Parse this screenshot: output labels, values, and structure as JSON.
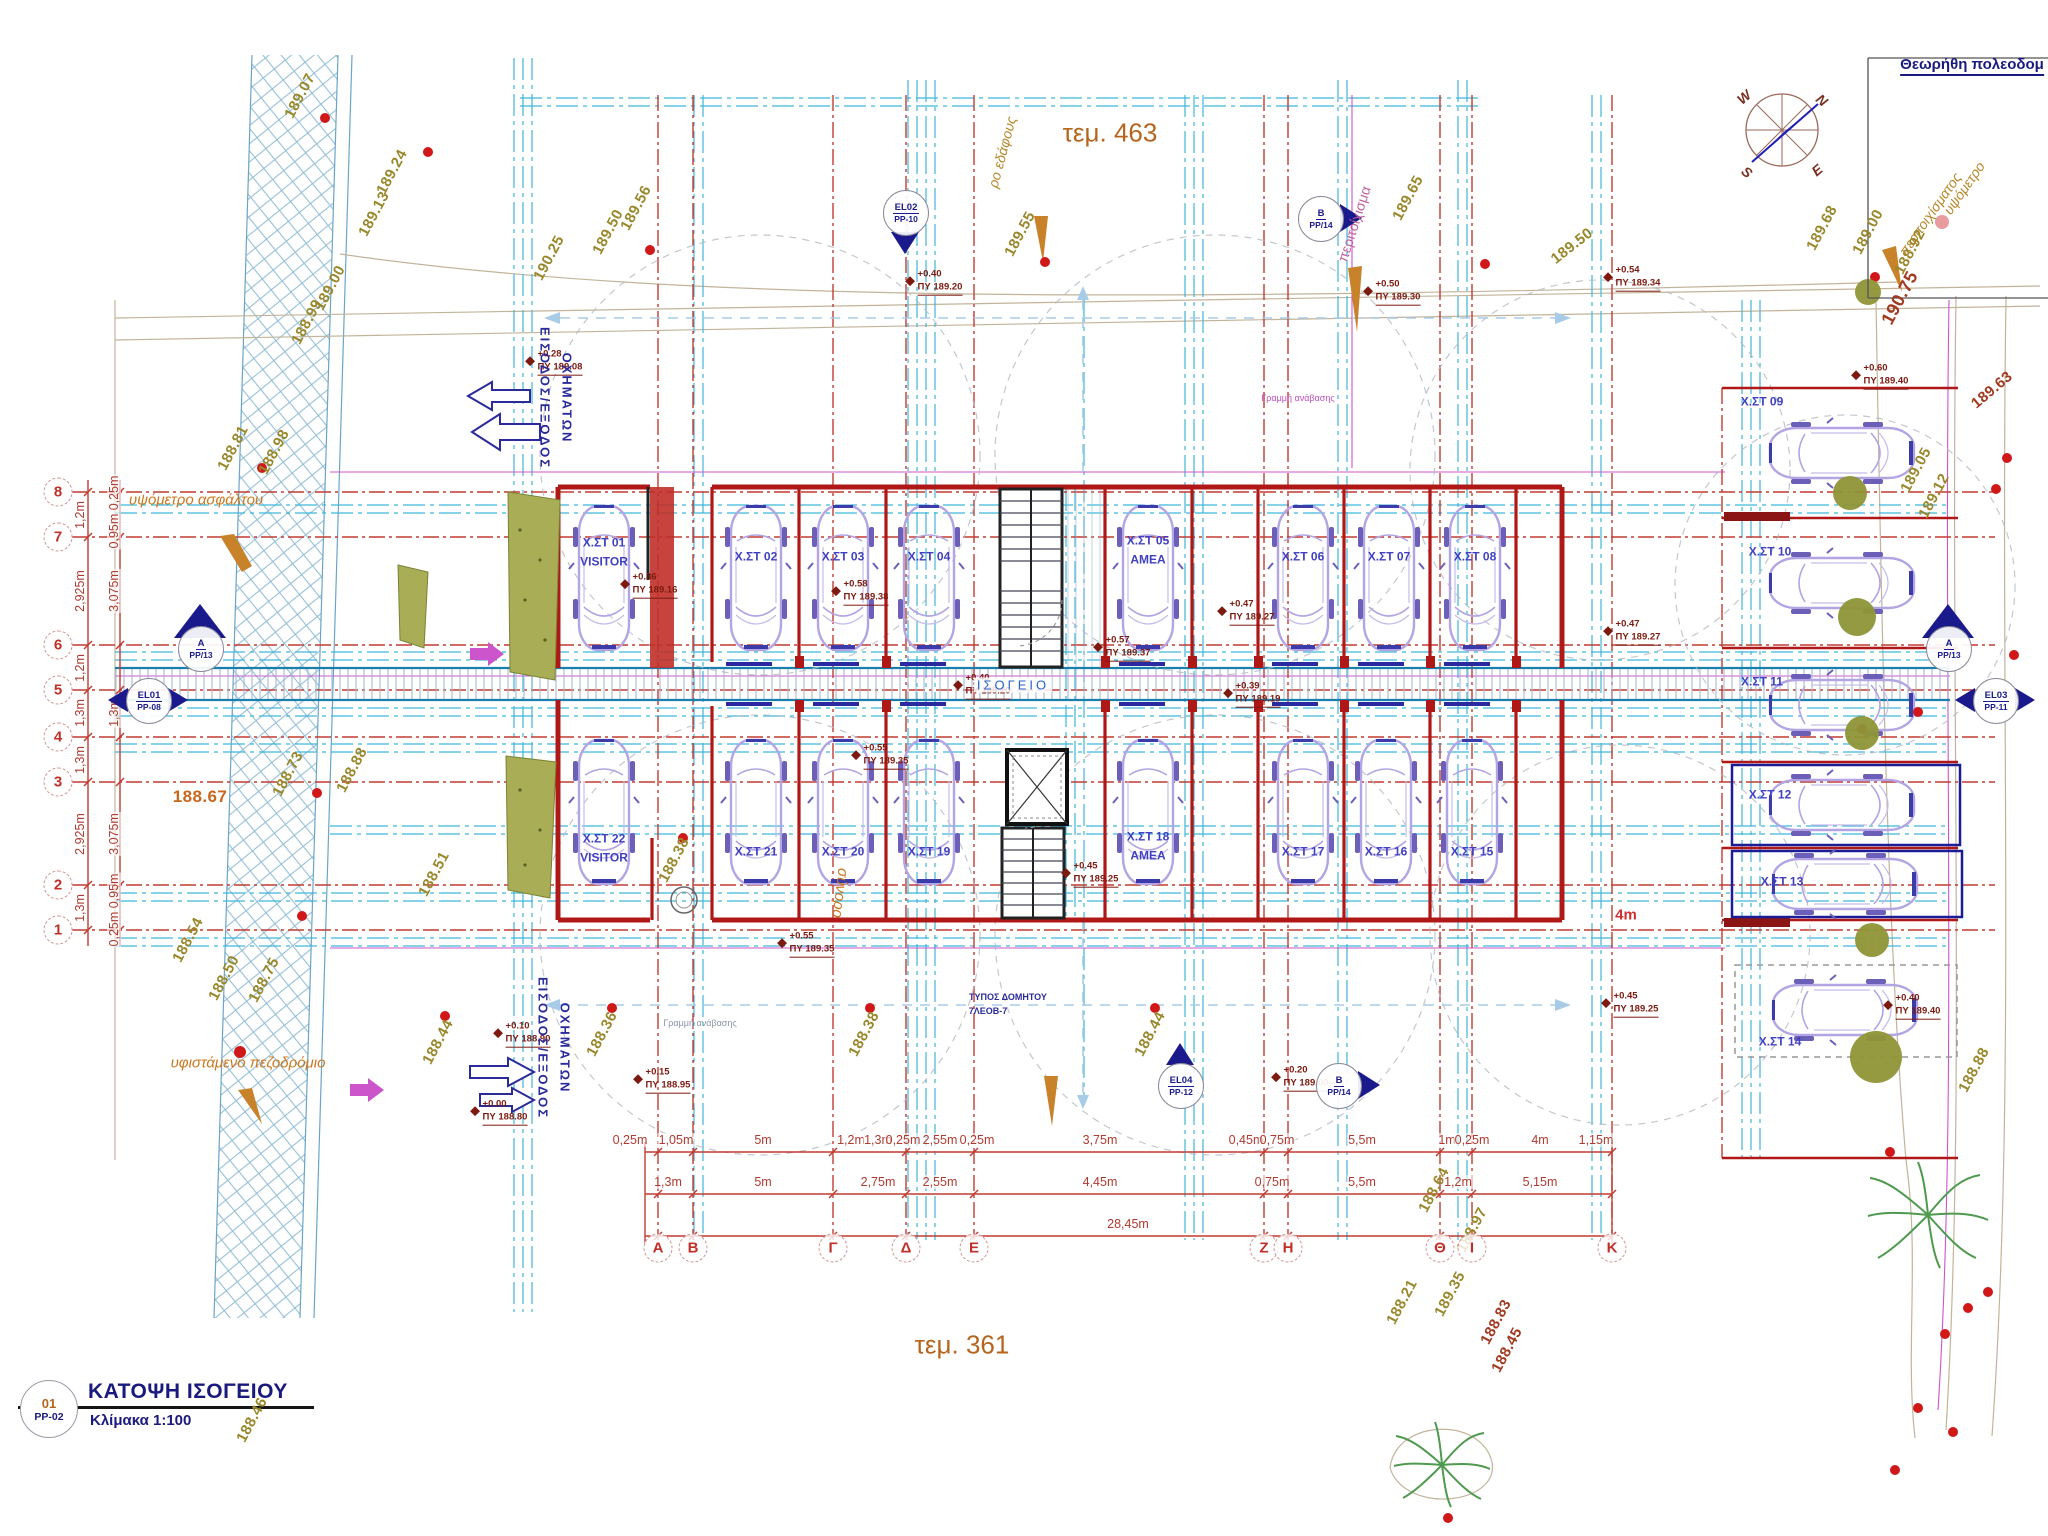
{
  "drawing": {
    "sheet_no": "01",
    "sheet_code": "PP-02",
    "title": "ΚΑΤΟΨΗ ΙΣΟΓΕΙΟΥ",
    "scale": "Κλίμακα 1:100",
    "approval_note": "Θεωρήθη πολεοδομ",
    "plot_top": "τεμ. 463",
    "plot_bottom": "τεμ. 361"
  },
  "compass": {
    "points": [
      {
        "t": "N",
        "x": 1822,
        "y": 100,
        "rot": 40
      },
      {
        "t": "W",
        "x": 1744,
        "y": 97,
        "rot": -40
      },
      {
        "t": "S",
        "x": 1747,
        "y": 172,
        "rot": 40
      },
      {
        "t": "E",
        "x": 1817,
        "y": 170,
        "rot": -40
      }
    ]
  },
  "column_grid": {
    "y": 1248,
    "labels": [
      {
        "t": "Α",
        "x": 658
      },
      {
        "t": "Β",
        "x": 693
      },
      {
        "t": "Γ",
        "x": 833
      },
      {
        "t": "Δ",
        "x": 906
      },
      {
        "t": "Ε",
        "x": 974
      },
      {
        "t": "Ζ",
        "x": 1264
      },
      {
        "t": "Η",
        "x": 1288
      },
      {
        "t": "Θ",
        "x": 1440
      },
      {
        "t": "Ι",
        "x": 1472
      },
      {
        "t": "Κ",
        "x": 1612
      }
    ]
  },
  "row_grid": {
    "x": 58,
    "labels": [
      {
        "t": "8",
        "y": 492
      },
      {
        "t": "7",
        "y": 537
      },
      {
        "t": "6",
        "y": 645
      },
      {
        "t": "5",
        "y": 690
      },
      {
        "t": "4",
        "y": 737
      },
      {
        "t": "3",
        "y": 782
      },
      {
        "t": "2",
        "y": 885
      },
      {
        "t": "1",
        "y": 930
      }
    ]
  },
  "parking_spots": [
    {
      "id": "Χ.ΣΤ 01",
      "note": "VISITOR",
      "x": 604,
      "y": 552
    },
    {
      "id": "Χ.ΣΤ 02",
      "x": 756,
      "y": 557
    },
    {
      "id": "Χ.ΣΤ 03",
      "x": 843,
      "y": 557
    },
    {
      "id": "Χ.ΣΤ 04",
      "x": 929,
      "y": 557
    },
    {
      "id": "Χ.ΣΤ 05",
      "note": "ΑΜΕΑ",
      "x": 1148,
      "y": 550
    },
    {
      "id": "Χ.ΣΤ 06",
      "x": 1303,
      "y": 557
    },
    {
      "id": "Χ.ΣΤ 07",
      "x": 1389,
      "y": 557
    },
    {
      "id": "Χ.ΣΤ 08",
      "x": 1475,
      "y": 557
    },
    {
      "id": "Χ.ΣΤ 22",
      "note": "VISITOR",
      "x": 604,
      "y": 848
    },
    {
      "id": "Χ.ΣΤ 21",
      "x": 756,
      "y": 852
    },
    {
      "id": "Χ.ΣΤ 20",
      "x": 843,
      "y": 852
    },
    {
      "id": "Χ.ΣΤ 19",
      "x": 929,
      "y": 852
    },
    {
      "id": "Χ.ΣΤ 18",
      "note": "ΑΜΕΑ",
      "x": 1148,
      "y": 846
    },
    {
      "id": "Χ.ΣΤ 17",
      "x": 1303,
      "y": 852
    },
    {
      "id": "Χ.ΣΤ 16",
      "x": 1386,
      "y": 852
    },
    {
      "id": "Χ.ΣΤ 15",
      "x": 1472,
      "y": 852
    },
    {
      "id": "Χ.ΣΤ 09",
      "x": 1762,
      "y": 402
    },
    {
      "id": "Χ.ΣΤ 10",
      "x": 1770,
      "y": 552
    },
    {
      "id": "Χ.ΣΤ 11",
      "x": 1762,
      "y": 682
    },
    {
      "id": "Χ.ΣΤ 12",
      "x": 1770,
      "y": 795
    },
    {
      "id": "Χ.ΣΤ 13",
      "x": 1782,
      "y": 882
    },
    {
      "id": "Χ.ΣΤ 14",
      "x": 1780,
      "y": 1042
    }
  ],
  "spot_levels": [
    {
      "rel": "+0.28",
      "abs": "ΠΥ 189.08",
      "x": 560,
      "y": 362
    },
    {
      "rel": "+0.40",
      "abs": "ΠΥ 189.20",
      "x": 940,
      "y": 282
    },
    {
      "rel": "+0.50",
      "abs": "ΠΥ 189.30",
      "x": 1398,
      "y": 292
    },
    {
      "rel": "+0.54",
      "abs": "ΠΥ 189.34",
      "x": 1638,
      "y": 278
    },
    {
      "rel": "+0.60",
      "abs": "ΠΥ 189.40",
      "x": 1886,
      "y": 376
    },
    {
      "rel": "+0.36",
      "abs": "ΠΥ 189.16",
      "x": 655,
      "y": 585
    },
    {
      "rel": "+0.58",
      "abs": "ΠΥ 189.38",
      "x": 866,
      "y": 592
    },
    {
      "rel": "+0.57",
      "abs": "ΠΥ 189.37",
      "x": 1128,
      "y": 648
    },
    {
      "rel": "+0.47",
      "abs": "ΠΥ 189.27",
      "x": 1252,
      "y": 612
    },
    {
      "rel": "+0.47",
      "abs": "ΠΥ 189.27",
      "x": 1638,
      "y": 632
    },
    {
      "rel": "+0.40",
      "abs": "ΠΥ 189.20",
      "x": 988,
      "y": 686
    },
    {
      "rel": "+0.39",
      "abs": "ΠΥ 189.19",
      "x": 1258,
      "y": 694
    },
    {
      "rel": "+0.55",
      "abs": "ΠΥ 189.35",
      "x": 886,
      "y": 756
    },
    {
      "rel": "+0.55",
      "abs": "ΠΥ 189.35",
      "x": 812,
      "y": 944
    },
    {
      "rel": "+0.45",
      "abs": "ΠΥ 189.25",
      "x": 1096,
      "y": 874
    },
    {
      "rel": "+0.45",
      "abs": "ΠΥ 189.25",
      "x": 1636,
      "y": 1004
    },
    {
      "rel": "+0.40",
      "abs": "ΠΥ 189.40",
      "x": 1918,
      "y": 1006
    },
    {
      "rel": "+0.15",
      "abs": "ΠΥ 188.95",
      "x": 668,
      "y": 1080
    },
    {
      "rel": "+0.20",
      "abs": "ΠΥ 189.00",
      "x": 1306,
      "y": 1078
    },
    {
      "rel": "+0.10",
      "abs": "ΠΥ 188.90",
      "x": 528,
      "y": 1034
    },
    {
      "rel": "+0.00",
      "abs": "ΠΥ 188.80",
      "x": 505,
      "y": 1112
    }
  ],
  "ground_elevations": [
    {
      "t": "189.07",
      "x": 300,
      "y": 96
    },
    {
      "t": "189.24",
      "x": 392,
      "y": 172
    },
    {
      "t": "189.13",
      "x": 374,
      "y": 214
    },
    {
      "t": "189.00",
      "x": 330,
      "y": 288
    },
    {
      "t": "188.99",
      "x": 307,
      "y": 322
    },
    {
      "t": "190.25",
      "x": 549,
      "y": 258
    },
    {
      "t": "189.50",
      "x": 608,
      "y": 232
    },
    {
      "t": "189.56",
      "x": 636,
      "y": 208
    },
    {
      "t": "189.55",
      "x": 1020,
      "y": 234
    },
    {
      "t": "189.65",
      "x": 1408,
      "y": 198
    },
    {
      "t": "189.50",
      "x": 1572,
      "y": 246,
      "rot": -38
    },
    {
      "t": "189.68",
      "x": 1822,
      "y": 228
    },
    {
      "t": "189.00",
      "x": 1868,
      "y": 232
    },
    {
      "t": "188.92",
      "x": 1910,
      "y": 252
    },
    {
      "t": "190.75",
      "x": 1900,
      "y": 298,
      "s": 18,
      "c": "#a03a20"
    },
    {
      "t": "189.63",
      "x": 1992,
      "y": 390,
      "rot": -40,
      "c": "#a03a20"
    },
    {
      "t": "189.05",
      "x": 1916,
      "y": 470
    },
    {
      "t": "189.12",
      "x": 1934,
      "y": 496
    },
    {
      "t": "188.81",
      "x": 233,
      "y": 448
    },
    {
      "t": "188.98",
      "x": 274,
      "y": 452
    },
    {
      "t": "188.73",
      "x": 288,
      "y": 774
    },
    {
      "t": "188.88",
      "x": 352,
      "y": 770
    },
    {
      "t": "188.67",
      "x": 200,
      "y": 797,
      "rot": 0,
      "s": 17,
      "c": "#c8671e"
    },
    {
      "t": "188.54",
      "x": 188,
      "y": 940
    },
    {
      "t": "188.50",
      "x": 224,
      "y": 978
    },
    {
      "t": "188.75",
      "x": 264,
      "y": 980
    },
    {
      "t": "188.46",
      "x": 252,
      "y": 1420
    },
    {
      "t": "188.51",
      "x": 434,
      "y": 874
    },
    {
      "t": "188.44",
      "x": 438,
      "y": 1042
    },
    {
      "t": "188.36",
      "x": 602,
      "y": 1034
    },
    {
      "t": "188.38",
      "x": 674,
      "y": 860
    },
    {
      "t": "188.38",
      "x": 864,
      "y": 1034
    },
    {
      "t": "188.44",
      "x": 1150,
      "y": 1034
    },
    {
      "t": "188.64",
      "x": 1434,
      "y": 1190
    },
    {
      "t": "188.97",
      "x": 1472,
      "y": 1230
    },
    {
      "t": "189.35",
      "x": 1450,
      "y": 1294
    },
    {
      "t": "188.21",
      "x": 1402,
      "y": 1302
    },
    {
      "t": "188.83",
      "x": 1496,
      "y": 1322,
      "c": "#a03a20"
    },
    {
      "t": "188.45",
      "x": 1507,
      "y": 1350,
      "c": "#a03a20"
    },
    {
      "t": "188.88",
      "x": 1974,
      "y": 1070
    }
  ],
  "dimensions": {
    "bottom1": {
      "y": 1140,
      "items": [
        {
          "t": "0,25m",
          "x": 630
        },
        {
          "t": "1,05m",
          "x": 676
        },
        {
          "t": "5m",
          "x": 763
        },
        {
          "t": "1,2m",
          "x": 851
        },
        {
          "t": "1,3m",
          "x": 878
        },
        {
          "t": "0,25m",
          "x": 903
        },
        {
          "t": "2,55m",
          "x": 940
        },
        {
          "t": "0,25m",
          "x": 977
        },
        {
          "t": "3,75m",
          "x": 1100
        },
        {
          "t": "0,45m",
          "x": 1246
        },
        {
          "t": "0,75m",
          "x": 1277
        },
        {
          "t": "5,5m",
          "x": 1362
        },
        {
          "t": "1m",
          "x": 1447
        },
        {
          "t": "0,25m",
          "x": 1472
        },
        {
          "t": "4m",
          "x": 1540
        },
        {
          "t": "1,15m",
          "x": 1596
        }
      ]
    },
    "bottom2": {
      "y": 1182,
      "items": [
        {
          "t": "1,3m",
          "x": 668
        },
        {
          "t": "5m",
          "x": 763
        },
        {
          "t": "2,75m",
          "x": 878
        },
        {
          "t": "2,55m",
          "x": 940
        },
        {
          "t": "4,45m",
          "x": 1100
        },
        {
          "t": "0,75m",
          "x": 1272
        },
        {
          "t": "5,5m",
          "x": 1362
        },
        {
          "t": "1,2m",
          "x": 1458
        },
        {
          "t": "5,15m",
          "x": 1540
        }
      ]
    },
    "total": {
      "t": "28,45m",
      "x": 1128,
      "y": 1224
    },
    "left1": {
      "x": 80,
      "items": [
        {
          "t": "1,2m",
          "y": 515
        },
        {
          "t": "2,925m",
          "y": 591
        },
        {
          "t": "1,2m",
          "y": 668
        },
        {
          "t": "1,3m",
          "y": 713
        },
        {
          "t": "1,3m",
          "y": 760
        },
        {
          "t": "2,925m",
          "y": 834
        },
        {
          "t": "1,3m",
          "y": 908
        }
      ]
    },
    "left2": {
      "x": 114,
      "items": [
        {
          "t": "0,95m 0,25m",
          "y": 512
        },
        {
          "t": "3,075m",
          "y": 591
        },
        {
          "t": "1,3m",
          "y": 713
        },
        {
          "t": "3,075m",
          "y": 834
        },
        {
          "t": "0,25m 0,95m",
          "y": 910
        }
      ]
    }
  },
  "markers": [
    {
      "id": "Α",
      "ref": "PP/13",
      "x": 200,
      "y": 648,
      "type": "secA"
    },
    {
      "id": "Α",
      "ref": "PP/13",
      "x": 1948,
      "y": 648,
      "type": "secA"
    },
    {
      "id": "Β",
      "ref": "PP/14",
      "x": 1320,
      "y": 218,
      "type": "right"
    },
    {
      "id": "Β",
      "ref": "PP/14",
      "x": 1338,
      "y": 1085,
      "type": "right"
    },
    {
      "id": "EL01",
      "ref": "PP-08",
      "x": 148,
      "y": 700,
      "type": "lr"
    },
    {
      "id": "EL02",
      "ref": "PP-10",
      "x": 905,
      "y": 212,
      "type": "down"
    },
    {
      "id": "EL03",
      "ref": "PP-11",
      "x": 1995,
      "y": 700,
      "type": "lr"
    },
    {
      "id": "EL04",
      "ref": "PP-12",
      "x": 1180,
      "y": 1085,
      "type": "up"
    }
  ],
  "annotations": [
    {
      "t": "υψόμετρο",
      "x": 1964,
      "y": 188,
      "rot": -55,
      "cls": "olv"
    },
    {
      "t": "περιτοιχίσματος",
      "x": 1930,
      "y": 214,
      "rot": -55,
      "cls": "olv"
    },
    {
      "t": "ρο εδάφους",
      "x": 1002,
      "y": 152,
      "rot": -75,
      "cls": "olv"
    },
    {
      "t": "περιτοίχισμα",
      "x": 1354,
      "y": 224,
      "rot": -72,
      "cls": "mag"
    },
    {
      "t": "υψόμετρο ασφάλτου",
      "x": 196,
      "y": 500,
      "cls": "org"
    },
    {
      "t": "υφιστάμενο πεζοδρόμιο",
      "x": 248,
      "y": 1063,
      "cls": "org"
    },
    {
      "t": "σύνορο",
      "x": 840,
      "y": 893,
      "rot": 97,
      "cls": "org"
    },
    {
      "t": "ΕΙΣΟΔΟΣ/ΕΞΟΔΟΣ",
      "x": 545,
      "y": 398,
      "rot": 90,
      "cls": "ent"
    },
    {
      "t": "ΟΧΗΜΑΤΩΝ",
      "x": 567,
      "y": 398,
      "rot": 90,
      "cls": "ent"
    },
    {
      "t": "ΕΙΣΟΔΟΣ/ΕΞΟΔΟΣ",
      "x": 543,
      "y": 1048,
      "rot": 90,
      "cls": "ent"
    },
    {
      "t": "ΟΧΗΜΑΤΩΝ",
      "x": 565,
      "y": 1048,
      "rot": 90,
      "cls": "ent"
    },
    {
      "t": "ΙΣΟΓΕΙΟ",
      "x": 1013,
      "y": 685,
      "cls": "grn"
    },
    {
      "t": "ΤΥΠΟΣ ΔΟΜΗΤΟΥ",
      "x": 1008,
      "y": 997,
      "cls": "tin"
    },
    {
      "t": "7ΛΕΟΒ-7",
      "x": 988,
      "y": 1011,
      "cls": "tin"
    },
    {
      "t": "Γραμμή ανάβασης",
      "x": 700,
      "y": 1023,
      "cls": "gry"
    },
    {
      "t": "Γραμμή ανάβασης",
      "x": 1298,
      "y": 398,
      "cls": "magt"
    },
    {
      "t": "4m",
      "x": 1626,
      "y": 915,
      "cls": "red15"
    }
  ]
}
